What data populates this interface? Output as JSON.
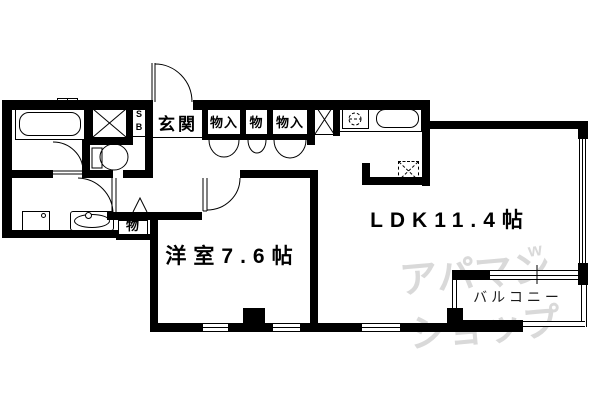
{
  "floorplan": {
    "rooms": {
      "ldk_label": "LDK11.4帖",
      "western_room_label": "洋室7.6帖",
      "balcony_label": "バルコニー",
      "entrance_label": "玄関",
      "closet_top_1": "物入",
      "closet_top_2": "物",
      "closet_top_3": "物入",
      "closet_hall": "物",
      "shoe_box_line1": "S",
      "shoe_box_line2": "B"
    },
    "watermark": {
      "line1": "アパマン",
      "line2": "ショップ",
      "accent": "w"
    },
    "colors": {
      "wall": "#000000",
      "background": "#ffffff",
      "watermark": "#d9d9d9"
    }
  }
}
